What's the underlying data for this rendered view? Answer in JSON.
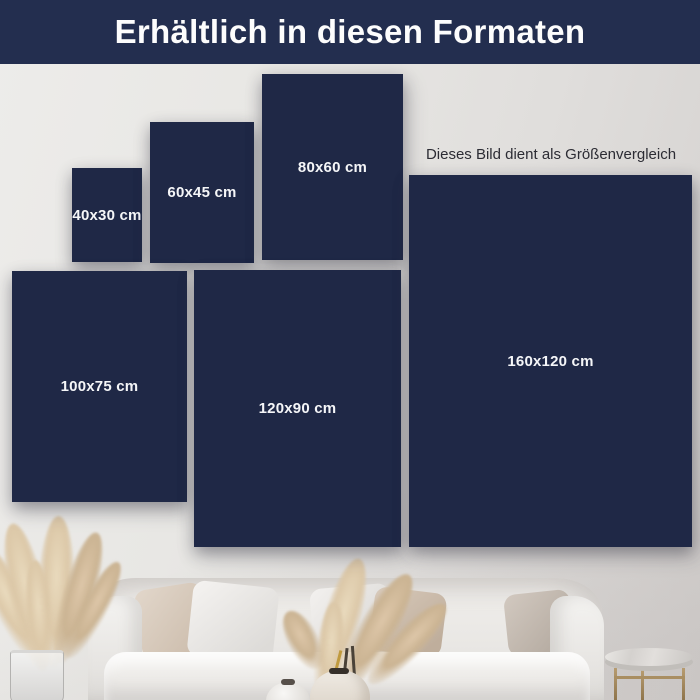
{
  "header": {
    "title": "Erhältlich in diesen Formaten"
  },
  "note": {
    "text": "Dieses Bild dient als Größenvergleich"
  },
  "colors": {
    "header_bg": "#232e4f",
    "canvas_navy": "#1f2846",
    "label_text": "#f5f6f8",
    "note_text": "#2c2c34",
    "wall_light": "#edecea",
    "wall_dark": "#d3d0ce",
    "pampas_beige": "#dcc8a8",
    "brass_leg": "#a98e62"
  },
  "formats": [
    {
      "label": "40x30 cm",
      "width_cm": 40,
      "height_cm": 30
    },
    {
      "label": "60x45 cm",
      "width_cm": 60,
      "height_cm": 45
    },
    {
      "label": "80x60 cm",
      "width_cm": 80,
      "height_cm": 60
    },
    {
      "label": "100x75 cm",
      "width_cm": 100,
      "height_cm": 75
    },
    {
      "label": "120x90 cm",
      "width_cm": 120,
      "height_cm": 90
    },
    {
      "label": "160x120 cm",
      "width_cm": 160,
      "height_cm": 120
    }
  ],
  "scene": {
    "decor": [
      "pampas-grass-left",
      "glass-vase",
      "white-sofa",
      "pillows",
      "pampas-grass-center",
      "ceramic-vase",
      "small-white-vase",
      "marble-side-table"
    ]
  }
}
